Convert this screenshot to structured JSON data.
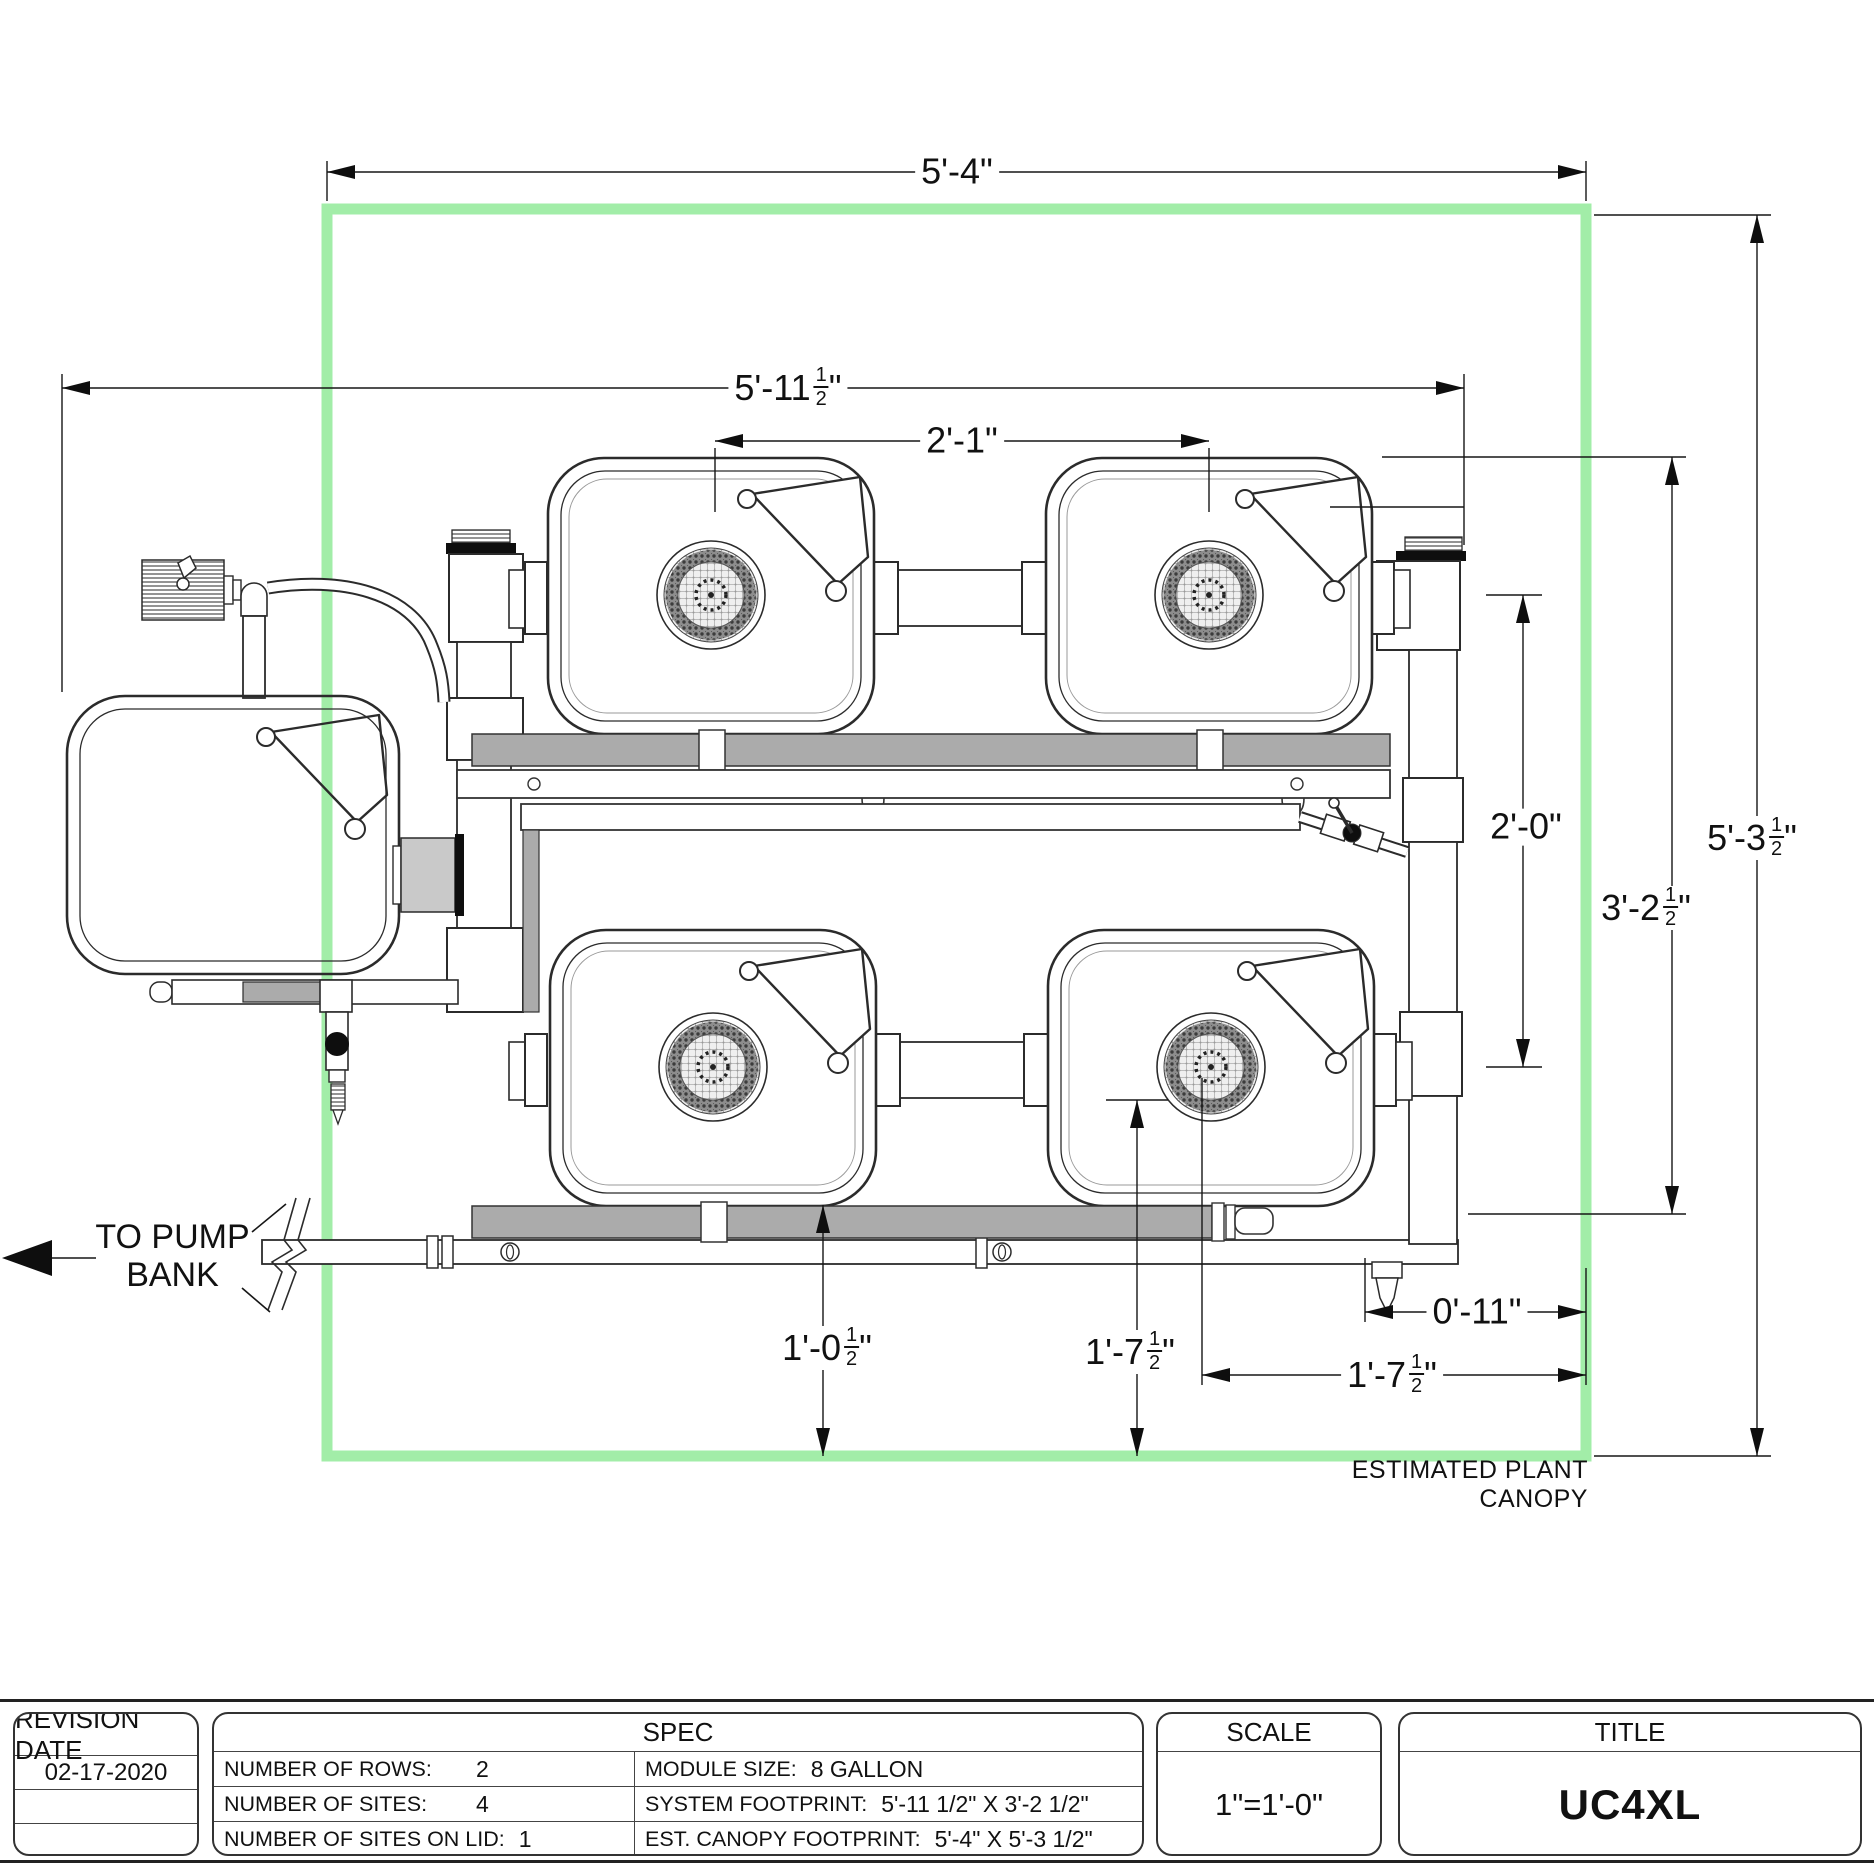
{
  "drawing": {
    "colors": {
      "canopy_green": "#a2eda8",
      "pipe_gray": "#ababab",
      "line_dark": "#2b2b2b"
    },
    "annotations": {
      "to_pump_line1": "TO PUMP",
      "to_pump_line2": "BANK",
      "canopy_label": "ESTIMATED PLANT CANOPY"
    },
    "dimensions": {
      "canopy_width": "5'-4\"",
      "system_width": {
        "pre": "5'-11",
        "num": "1",
        "den": "2",
        "suf": "\""
      },
      "site_spacing": "2'-1\"",
      "row_spacing": "2'-0\"",
      "system_depth": {
        "pre": "3'-2",
        "num": "1",
        "den": "2",
        "suf": "\""
      },
      "canopy_depth": {
        "pre": "5'-3",
        "num": "1",
        "den": "2",
        "suf": "\""
      },
      "module_to_canopy": {
        "pre": "1'-0",
        "num": "1",
        "den": "2",
        "suf": "\""
      },
      "site_to_canopy_v": {
        "pre": "1'-7",
        "num": "1",
        "den": "2",
        "suf": "\""
      },
      "trunk_to_canopy": "0'-11\"",
      "site_to_canopy_h": {
        "pre": "1'-7",
        "num": "1",
        "den": "2",
        "suf": "\""
      }
    }
  },
  "title_block": {
    "revision": {
      "header": "REVISION DATE",
      "date": "02-17-2020"
    },
    "spec": {
      "header": "SPEC",
      "left_rows": [
        {
          "label": "NUMBER OF ROWS:",
          "value": "2"
        },
        {
          "label": "NUMBER OF SITES:",
          "value": "4"
        },
        {
          "label": "NUMBER OF SITES ON LID:",
          "value": "1"
        }
      ],
      "right_rows": [
        {
          "label": "MODULE SIZE:",
          "value": "8 GALLON"
        },
        {
          "label": "SYSTEM FOOTPRINT:",
          "value": "5'-11 1/2\" X 3'-2 1/2\""
        },
        {
          "label": "EST. CANOPY FOOTPRINT:",
          "value": "5'-4\" X 5'-3 1/2\""
        }
      ]
    },
    "scale": {
      "header": "SCALE",
      "value": "1\"=1'-0\""
    },
    "title": {
      "header": "TITLE",
      "value": "UC4XL"
    }
  }
}
